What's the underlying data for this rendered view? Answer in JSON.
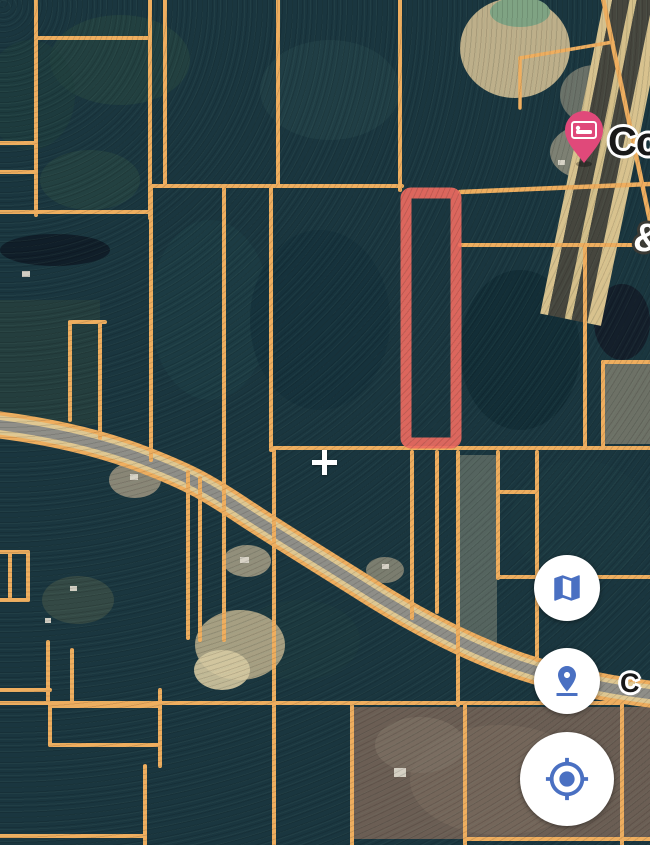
{
  "app": {
    "view": "satellite-parcel-map"
  },
  "map": {
    "labels": {
      "poi_top": {
        "text": "Co",
        "x": 608,
        "y": 120,
        "size": 40,
        "style": "dark-on-white",
        "note": "clipped at right edge"
      },
      "road_right": {
        "text": "C",
        "x": 620,
        "y": 668,
        "size": 27,
        "style": "dark-on-white",
        "note": "clipped at right edge"
      },
      "partial_glyph": {
        "text": "&",
        "x": 633,
        "y": 216,
        "size": 40,
        "style": "white-on-dark",
        "note": "clipped at right edge"
      }
    },
    "poi": {
      "kind": "lodging",
      "pin_color": "#e0497a",
      "tip_x": 584,
      "tip_y": 163
    },
    "crosshair": {
      "x": 324,
      "y": 462,
      "color": "#ffffff"
    },
    "colors": {
      "forest_base": "#1a363f",
      "parcel_line": "#efae5f",
      "selected_parcel": "#ed6a60",
      "road_casing": "#e0c892",
      "road_fill": "#8f8e88",
      "highway_lane": "#46463e",
      "highway_median": "#d6c08c",
      "pond_green": "#7fa383",
      "pond_dark": "#141f2b",
      "field_brown": "#6b5e54",
      "sand": "#c6b68e"
    },
    "selected_parcel": {
      "x": 406,
      "y": 193,
      "width": 50,
      "height": 250,
      "stroke_width": 11
    },
    "road_path": "M-8,424 C40,430 95,441 142,459 C186,476 205,486 238,508 C272,531 320,560 372,593 C420,623 468,648 520,666 C562,680 612,690 658,695",
    "highway": {
      "pivot_x": 604,
      "angle_deg": 11.5,
      "stripes": [
        [
          0,
          8,
          "#d8c28e"
        ],
        [
          8,
          17,
          "#46463e"
        ],
        [
          25,
          7,
          "#d4bf8a"
        ],
        [
          32,
          16,
          "#46463e"
        ],
        [
          48,
          14,
          "#d8c28e"
        ]
      ]
    },
    "boundary_paths": [
      [
        "M602,-6 L654,240",
        4.5
      ],
      [
        "M520,58 L613,42",
        3.5
      ],
      [
        "M520,58 L520,108",
        3.5
      ],
      [
        "M460,192 L650,184",
        4.5
      ]
    ],
    "parcel_lines": [
      [
        36,
        0,
        36,
        215
      ],
      [
        150,
        0,
        150,
        218
      ],
      [
        36,
        38,
        150,
        38
      ],
      [
        0,
        143,
        36,
        143
      ],
      [
        0,
        172,
        36,
        172
      ],
      [
        0,
        212,
        150,
        212
      ],
      [
        165,
        0,
        165,
        186
      ],
      [
        278,
        0,
        278,
        186
      ],
      [
        400,
        0,
        400,
        190
      ],
      [
        151,
        186,
        402,
        186
      ],
      [
        151,
        186,
        151,
        460
      ],
      [
        224,
        186,
        224,
        640
      ],
      [
        271,
        186,
        271,
        450
      ],
      [
        274,
        448,
        274,
        845
      ],
      [
        275,
        448,
        650,
        448
      ],
      [
        188,
        472,
        188,
        638
      ],
      [
        200,
        478,
        200,
        640
      ],
      [
        100,
        322,
        100,
        438
      ],
      [
        70,
        322,
        70,
        420
      ],
      [
        70,
        322,
        105,
        322
      ],
      [
        10,
        552,
        10,
        600
      ],
      [
        28,
        552,
        28,
        600
      ],
      [
        0,
        552,
        28,
        552
      ],
      [
        0,
        600,
        28,
        600
      ],
      [
        412,
        452,
        412,
        618
      ],
      [
        437,
        452,
        437,
        612
      ],
      [
        458,
        452,
        458,
        705
      ],
      [
        498,
        452,
        498,
        578
      ],
      [
        537,
        452,
        537,
        660
      ],
      [
        498,
        492,
        537,
        492
      ],
      [
        498,
        577,
        650,
        577
      ],
      [
        460,
        245,
        650,
        245
      ],
      [
        585,
        245,
        585,
        448
      ],
      [
        603,
        362,
        650,
        362
      ],
      [
        603,
        362,
        603,
        446
      ],
      [
        0,
        703,
        622,
        703
      ],
      [
        352,
        706,
        352,
        845
      ],
      [
        465,
        703,
        465,
        845
      ],
      [
        622,
        703,
        622,
        845
      ],
      [
        465,
        839,
        650,
        839
      ],
      [
        50,
        706,
        160,
        706
      ],
      [
        50,
        745,
        160,
        745
      ],
      [
        50,
        706,
        50,
        745
      ],
      [
        160,
        690,
        160,
        766
      ],
      [
        145,
        766,
        145,
        845
      ],
      [
        0,
        836,
        145,
        836
      ],
      [
        0,
        690,
        50,
        690
      ],
      [
        48,
        642,
        48,
        703
      ],
      [
        72,
        650,
        72,
        703
      ]
    ],
    "terrain_patches": [
      [
        "e",
        120,
        60,
        70,
        45,
        "#274641",
        0.65
      ],
      [
        "e",
        330,
        90,
        70,
        50,
        "#24454a",
        0.6
      ],
      [
        "e",
        30,
        95,
        45,
        55,
        "#20403e",
        0.6
      ],
      [
        "e",
        90,
        180,
        50,
        30,
        "#2c4a43",
        0.55
      ],
      [
        "e",
        210,
        310,
        60,
        90,
        "#1d3d45",
        0.8
      ],
      [
        "e",
        320,
        320,
        70,
        90,
        "#15323c",
        0.8
      ],
      [
        "e",
        520,
        350,
        60,
        80,
        "#122c36",
        0.75
      ],
      [
        "e",
        580,
        520,
        70,
        60,
        "#1b3941",
        0.8
      ],
      [
        "e",
        300,
        640,
        60,
        40,
        "#1e3c40",
        0.6
      ],
      [
        "r",
        0,
        300,
        100,
        125,
        "#31493f",
        0.45
      ],
      [
        "e",
        515,
        48,
        55,
        50,
        "#c6b68e",
        0.95
      ],
      [
        "e",
        520,
        12,
        30,
        15,
        "#7fa383",
        1
      ],
      [
        "e",
        595,
        95,
        35,
        30,
        "#8d8a7a",
        0.7
      ],
      [
        "e",
        630,
        60,
        25,
        40,
        "#9a9588",
        0.6
      ],
      [
        "e",
        590,
        152,
        40,
        28,
        "#8f8d7c",
        0.85
      ],
      [
        "e",
        55,
        250,
        55,
        16,
        "#101e29",
        1
      ],
      [
        "e",
        622,
        322,
        28,
        38,
        "#141f2b",
        1
      ],
      [
        "r",
        604,
        364,
        46,
        80,
        "#8a8674",
        0.75
      ],
      [
        "r",
        460,
        455,
        37,
        190,
        "#8f9180",
        0.5
      ],
      [
        "e",
        240,
        645,
        45,
        35,
        "#c0b28e",
        0.85
      ],
      [
        "e",
        222,
        670,
        28,
        20,
        "#d6c9a1",
        0.9
      ],
      [
        "r",
        353,
        707,
        297,
        132,
        "#6b5e54",
        1
      ],
      [
        "e",
        500,
        780,
        90,
        55,
        "#75675c",
        0.85
      ],
      [
        "e",
        420,
        745,
        45,
        28,
        "#7d7064",
        0.7
      ],
      [
        "e",
        135,
        480,
        26,
        18,
        "#a59b85",
        0.8
      ],
      [
        "e",
        247,
        561,
        24,
        16,
        "#b0a68b",
        0.8
      ],
      [
        "e",
        385,
        570,
        19,
        13,
        "#a59b85",
        0.7
      ],
      [
        "e",
        78,
        600,
        36,
        24,
        "#46564a",
        0.6
      ]
    ],
    "houses": [
      [
        22,
        271,
        8,
        6
      ],
      [
        130,
        474,
        8,
        6
      ],
      [
        240,
        557,
        9,
        6
      ],
      [
        382,
        564,
        7,
        5
      ],
      [
        70,
        586,
        7,
        5
      ],
      [
        45,
        618,
        6,
        5
      ],
      [
        394,
        768,
        12,
        9
      ],
      [
        580,
        124,
        8,
        6
      ],
      [
        558,
        160,
        7,
        5
      ]
    ],
    "house_color": "#dcd7ca"
  },
  "controls": {
    "accent_color": "#4a70c2",
    "map_type": {
      "name": "map-type-button",
      "icon": "map-icon"
    },
    "pin_drop": {
      "name": "dropped-pin-button",
      "icon": "pin-drop-icon"
    },
    "my_location": {
      "name": "my-location-button",
      "icon": "my-location-icon"
    }
  }
}
